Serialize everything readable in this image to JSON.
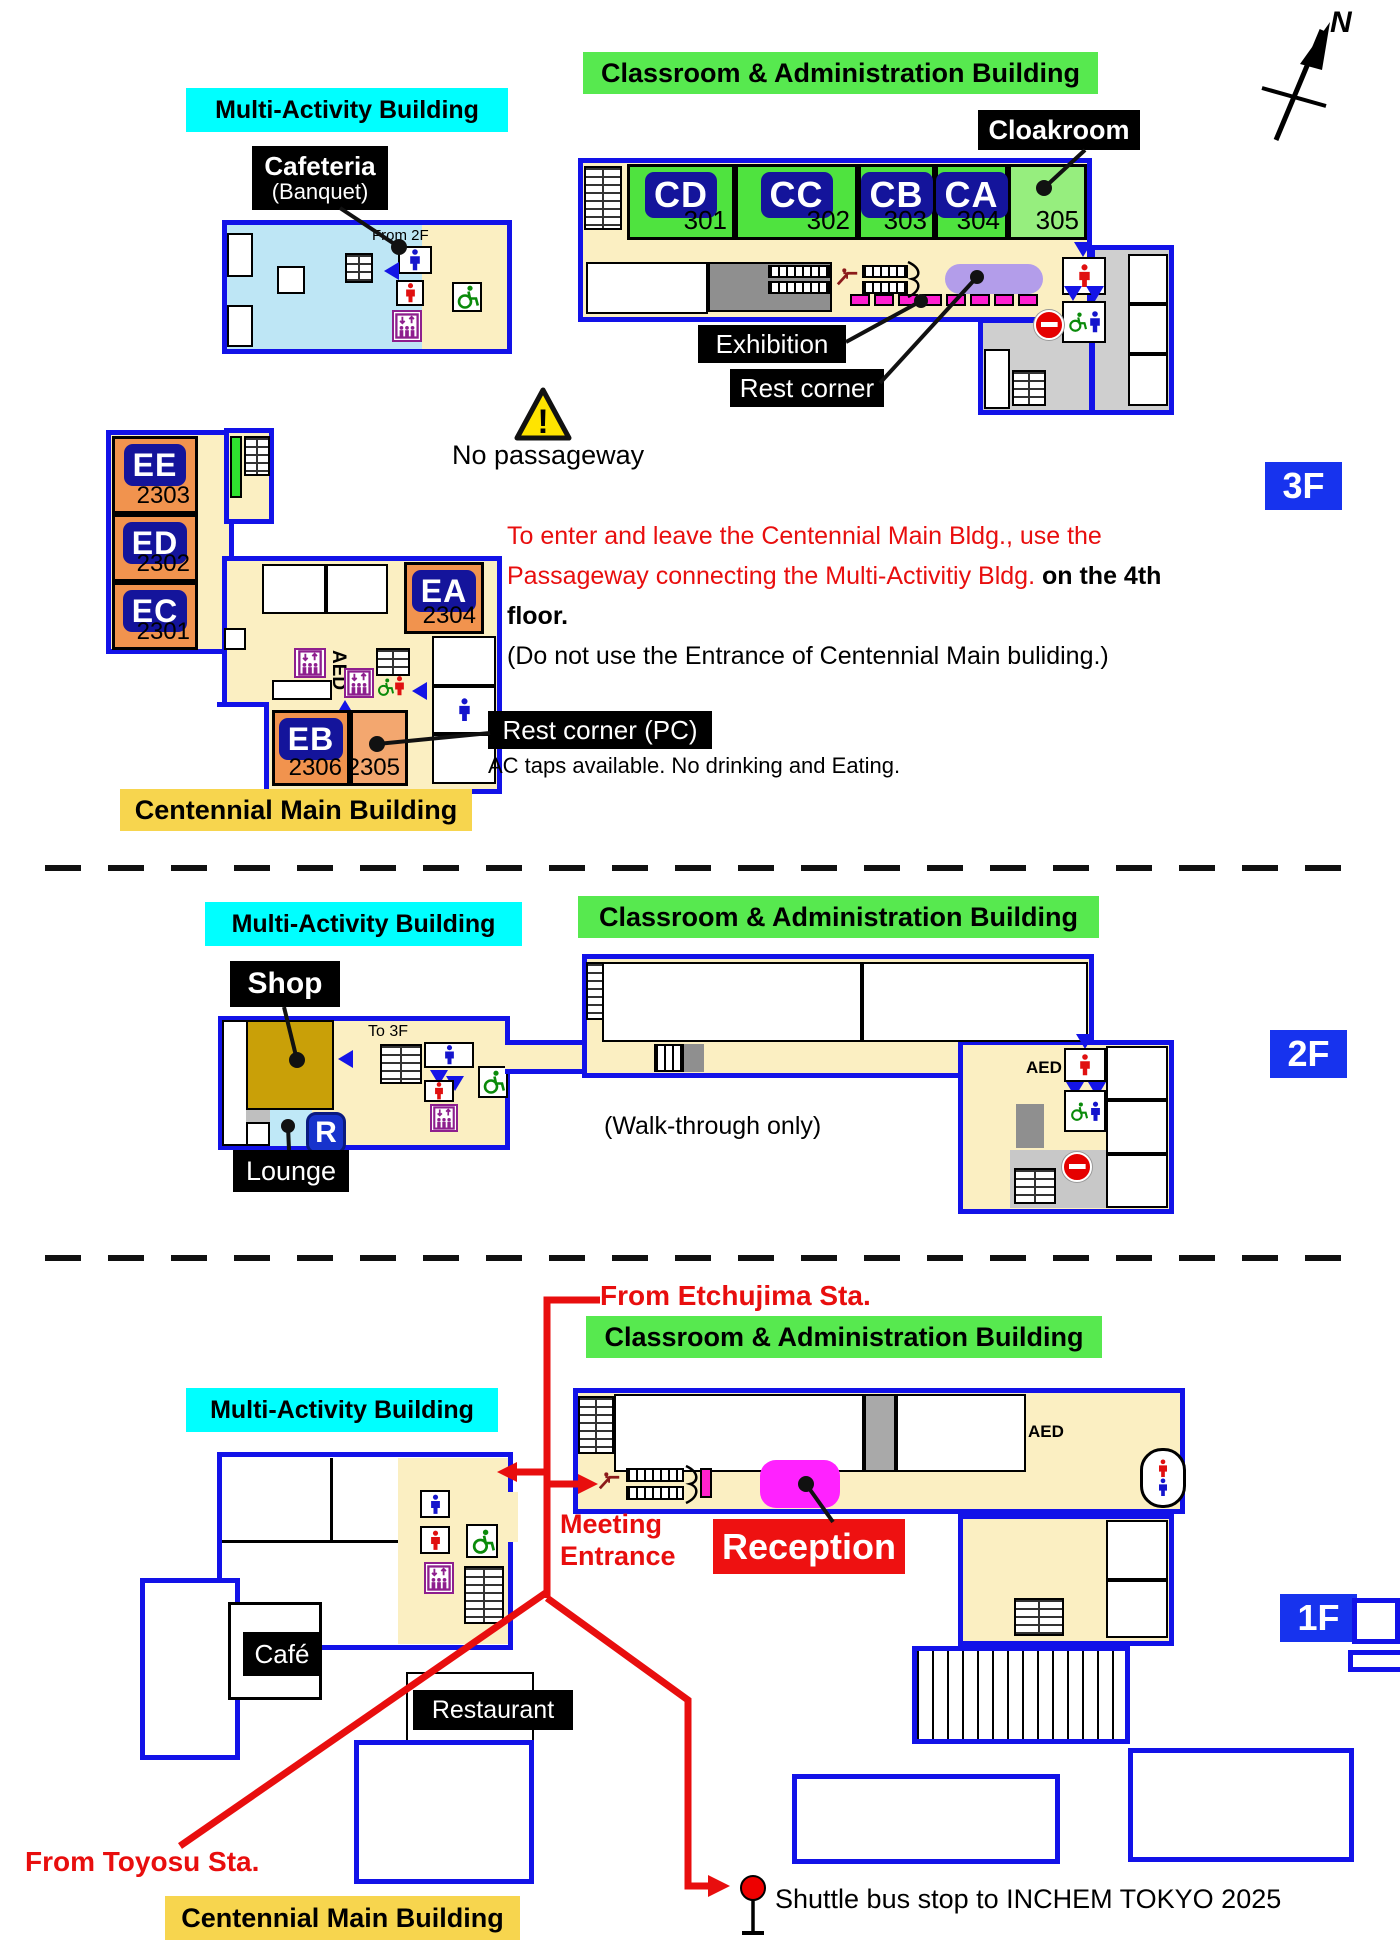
{
  "compass": {
    "label": "N"
  },
  "colors": {
    "building_outline": "#1212E8",
    "floor_cream": "#FBEFC2",
    "label_cyan": "#00FFFF",
    "label_green": "#57E94F",
    "label_yellow": "#F7D54E",
    "room_green": "#4FE33F",
    "room_green_light": "#96EE7E",
    "room_orange": "#F1934E",
    "plate_navy": "#14149B",
    "badge_blue": "#1733EE",
    "route_red": "#E80E0E",
    "reception_magenta": "#FF22FF",
    "sofa_purple": "#B39DEA",
    "shop_brown": "#C9A008",
    "lounge_blue": "#BFE8F7",
    "cafeteria_blue": "#BEE6F5",
    "warning_yellow": "#FFE400"
  },
  "floor3": {
    "badge": "3F",
    "multi_activity": {
      "label": "Multi-Activity Building",
      "cafeteria": "Cafeteria",
      "banquet": "(Banquet)",
      "from_2f": "From 2F"
    },
    "classroom": {
      "label": "Classroom & Administration Building",
      "cloakroom": "Cloakroom",
      "rooms": [
        {
          "code": "CD",
          "num": "301"
        },
        {
          "code": "CC",
          "num": "302"
        },
        {
          "code": "CB",
          "num": "303"
        },
        {
          "code": "CA",
          "num": "304"
        },
        {
          "code": "",
          "num": "305"
        }
      ],
      "exhibition": "Exhibition",
      "rest_corner": "Rest corner"
    },
    "warning": {
      "mark": "!",
      "text": "No passageway"
    },
    "notice": {
      "line1": "To enter and leave the Centennial Main Bldg., use the",
      "line2_red": "Passageway connecting the Multi-Activitiy Bldg. ",
      "line2_bold": "on the 4th floor.",
      "line3": "(Do not use the Entrance of Centennial Main buliding.)"
    },
    "centennial": {
      "label": "Centennial Main Building",
      "rooms": [
        {
          "code": "EE",
          "num": "2303"
        },
        {
          "code": "ED",
          "num": "2302"
        },
        {
          "code": "EC",
          "num": "2301"
        },
        {
          "code": "EA",
          "num": "2304"
        },
        {
          "code": "EB",
          "num": "2306"
        },
        {
          "code": "",
          "num": "2305"
        }
      ],
      "aed": "AED",
      "rest_corner_pc": "Rest corner (PC)",
      "rest_note": "AC taps available. No drinking and Eating."
    }
  },
  "floor2": {
    "badge": "2F",
    "multi_activity": {
      "label": "Multi-Activity Building",
      "shop": "Shop",
      "lounge": "Lounge",
      "r_badge": "R",
      "to_3f": "To 3F"
    },
    "classroom": {
      "label": "Classroom & Administration Building",
      "walk": "(Walk-through only)",
      "aed": "AED"
    }
  },
  "floor1": {
    "badge": "1F",
    "multi_activity": {
      "label": "Multi-Activity Building"
    },
    "classroom": {
      "label": "Classroom & Administration Building",
      "aed": "AED"
    },
    "from_etchujima": "From Etchujima Sta.",
    "from_toyosu": "From Toyosu Sta.",
    "meeting1": "Meeting",
    "meeting2": "Entrance",
    "reception": "Reception",
    "cafe": "Café",
    "restaurant": "Restaurant",
    "centennial_label": "Centennial Main Building",
    "shuttle": "Shuttle bus stop to INCHEM TOKYO 2025"
  }
}
